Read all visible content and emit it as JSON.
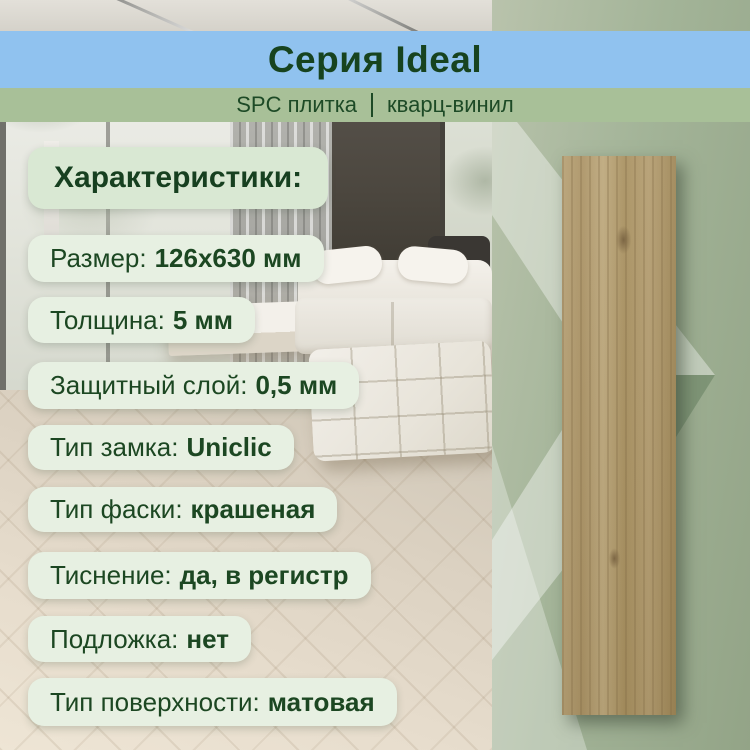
{
  "header": {
    "title": "Серия Ideal",
    "subtitle": {
      "left": "SPC плитка",
      "right": "кварц-винил"
    }
  },
  "specs": {
    "heading": "Характеристики:",
    "items": [
      {
        "label": "Размер:",
        "value": "126х630 мм"
      },
      {
        "label": "Толщина:",
        "value": "5 мм"
      },
      {
        "label": "Защитный слой:",
        "value": "0,5 мм"
      },
      {
        "label": "Тип замка:",
        "value": "Uniclic"
      },
      {
        "label": "Тип фаски:",
        "value": "крашеная"
      },
      {
        "label": "Тиснение:",
        "value": "да, в регистр"
      },
      {
        "label": "Подложка:",
        "value": "нет"
      },
      {
        "label": "Тип поверхности:",
        "value": "матовая"
      }
    ]
  },
  "colors": {
    "banner_blue": "#90c2ef",
    "banner_green": "#a8c098",
    "text_green": "#1c4722",
    "pill_bg": "#e7f0e2",
    "heading_pill_bg": "#d9e8d3",
    "panel_green": "#a3b498",
    "wood_light": "#b7a175",
    "wood_dark": "#9e8656"
  }
}
